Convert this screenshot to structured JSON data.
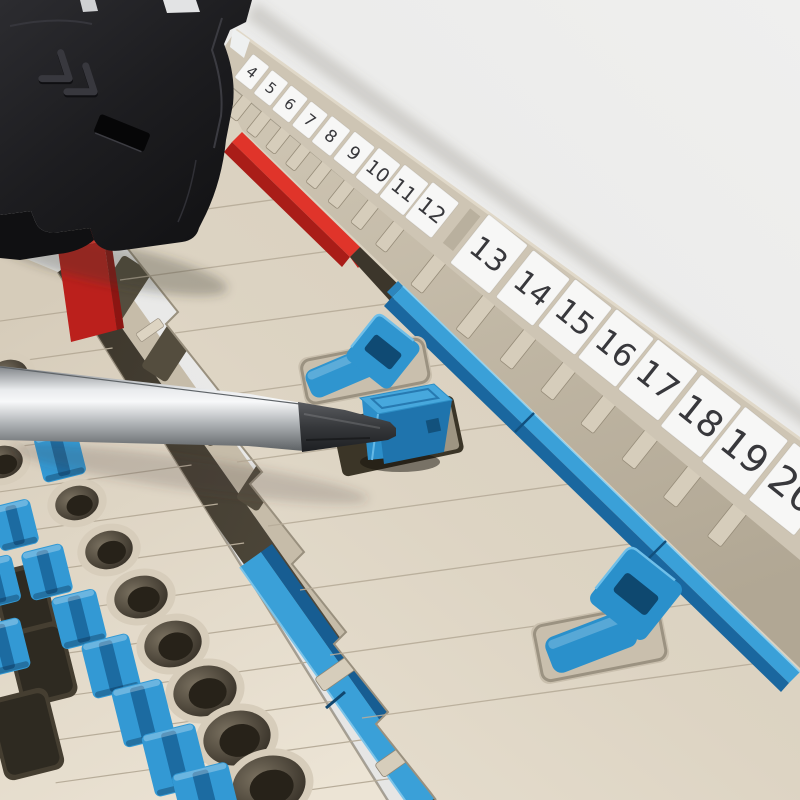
{
  "scene": {
    "type": "product-photo",
    "subject": "DIN-rail terminal block assembly with numbered marker strip, blue cross-connection sliders, red end plates, black module and screwdriver",
    "background_color": "#e9e9e8"
  },
  "marker_strip": {
    "cards": [
      {
        "name": "marker-card-1",
        "labels": [
          "4",
          "5",
          "6",
          "7",
          "8",
          "9",
          "10",
          "11",
          "12"
        ]
      },
      {
        "name": "marker-card-2",
        "labels": [
          "13",
          "14",
          "15",
          "16",
          "17",
          "18",
          "19",
          "20"
        ]
      }
    ],
    "tag_color": "#f7f7f6",
    "number_color": "#38383c",
    "frame_color": "#cec5b4"
  },
  "palette": {
    "background": "#e9e9e8",
    "housing_beige": "#d8cfbe",
    "housing_beige_light": "#e7dfd0",
    "housing_beige_dark": "#b9ae9b",
    "ridge_tan": "#c8bead",
    "wall_tan": "#c6bca9",
    "trench_dark": "#9a9080",
    "slot_dark": "#544d3e",
    "accent_blue": "#2f95cf",
    "accent_blue_light": "#47a9de",
    "accent_blue_dark": "#175d92",
    "accent_red": "#e0342a",
    "accent_red_dark": "#a91d18",
    "module_black": "#1d1d20",
    "steel_light": "#f5f6f7",
    "steel_dark": "#6e7275",
    "tip_dark": "#2b2d30",
    "hole_dark": "#352f26",
    "marker_white": "#f7f7f6",
    "number_dark": "#38383c",
    "line_tan": "#b7ac99"
  },
  "parts": [
    {
      "name": "black-module"
    },
    {
      "name": "red-end-plate-left"
    },
    {
      "name": "red-cross-rail"
    },
    {
      "name": "blue-cross-rail-main"
    },
    {
      "name": "blue-cross-rail-left"
    },
    {
      "name": "blue-slider-upper"
    },
    {
      "name": "blue-slider-engaged"
    },
    {
      "name": "blue-slider-lower"
    },
    {
      "name": "screwdriver"
    },
    {
      "name": "test-socket-holes"
    },
    {
      "name": "push-in-levers"
    }
  ]
}
